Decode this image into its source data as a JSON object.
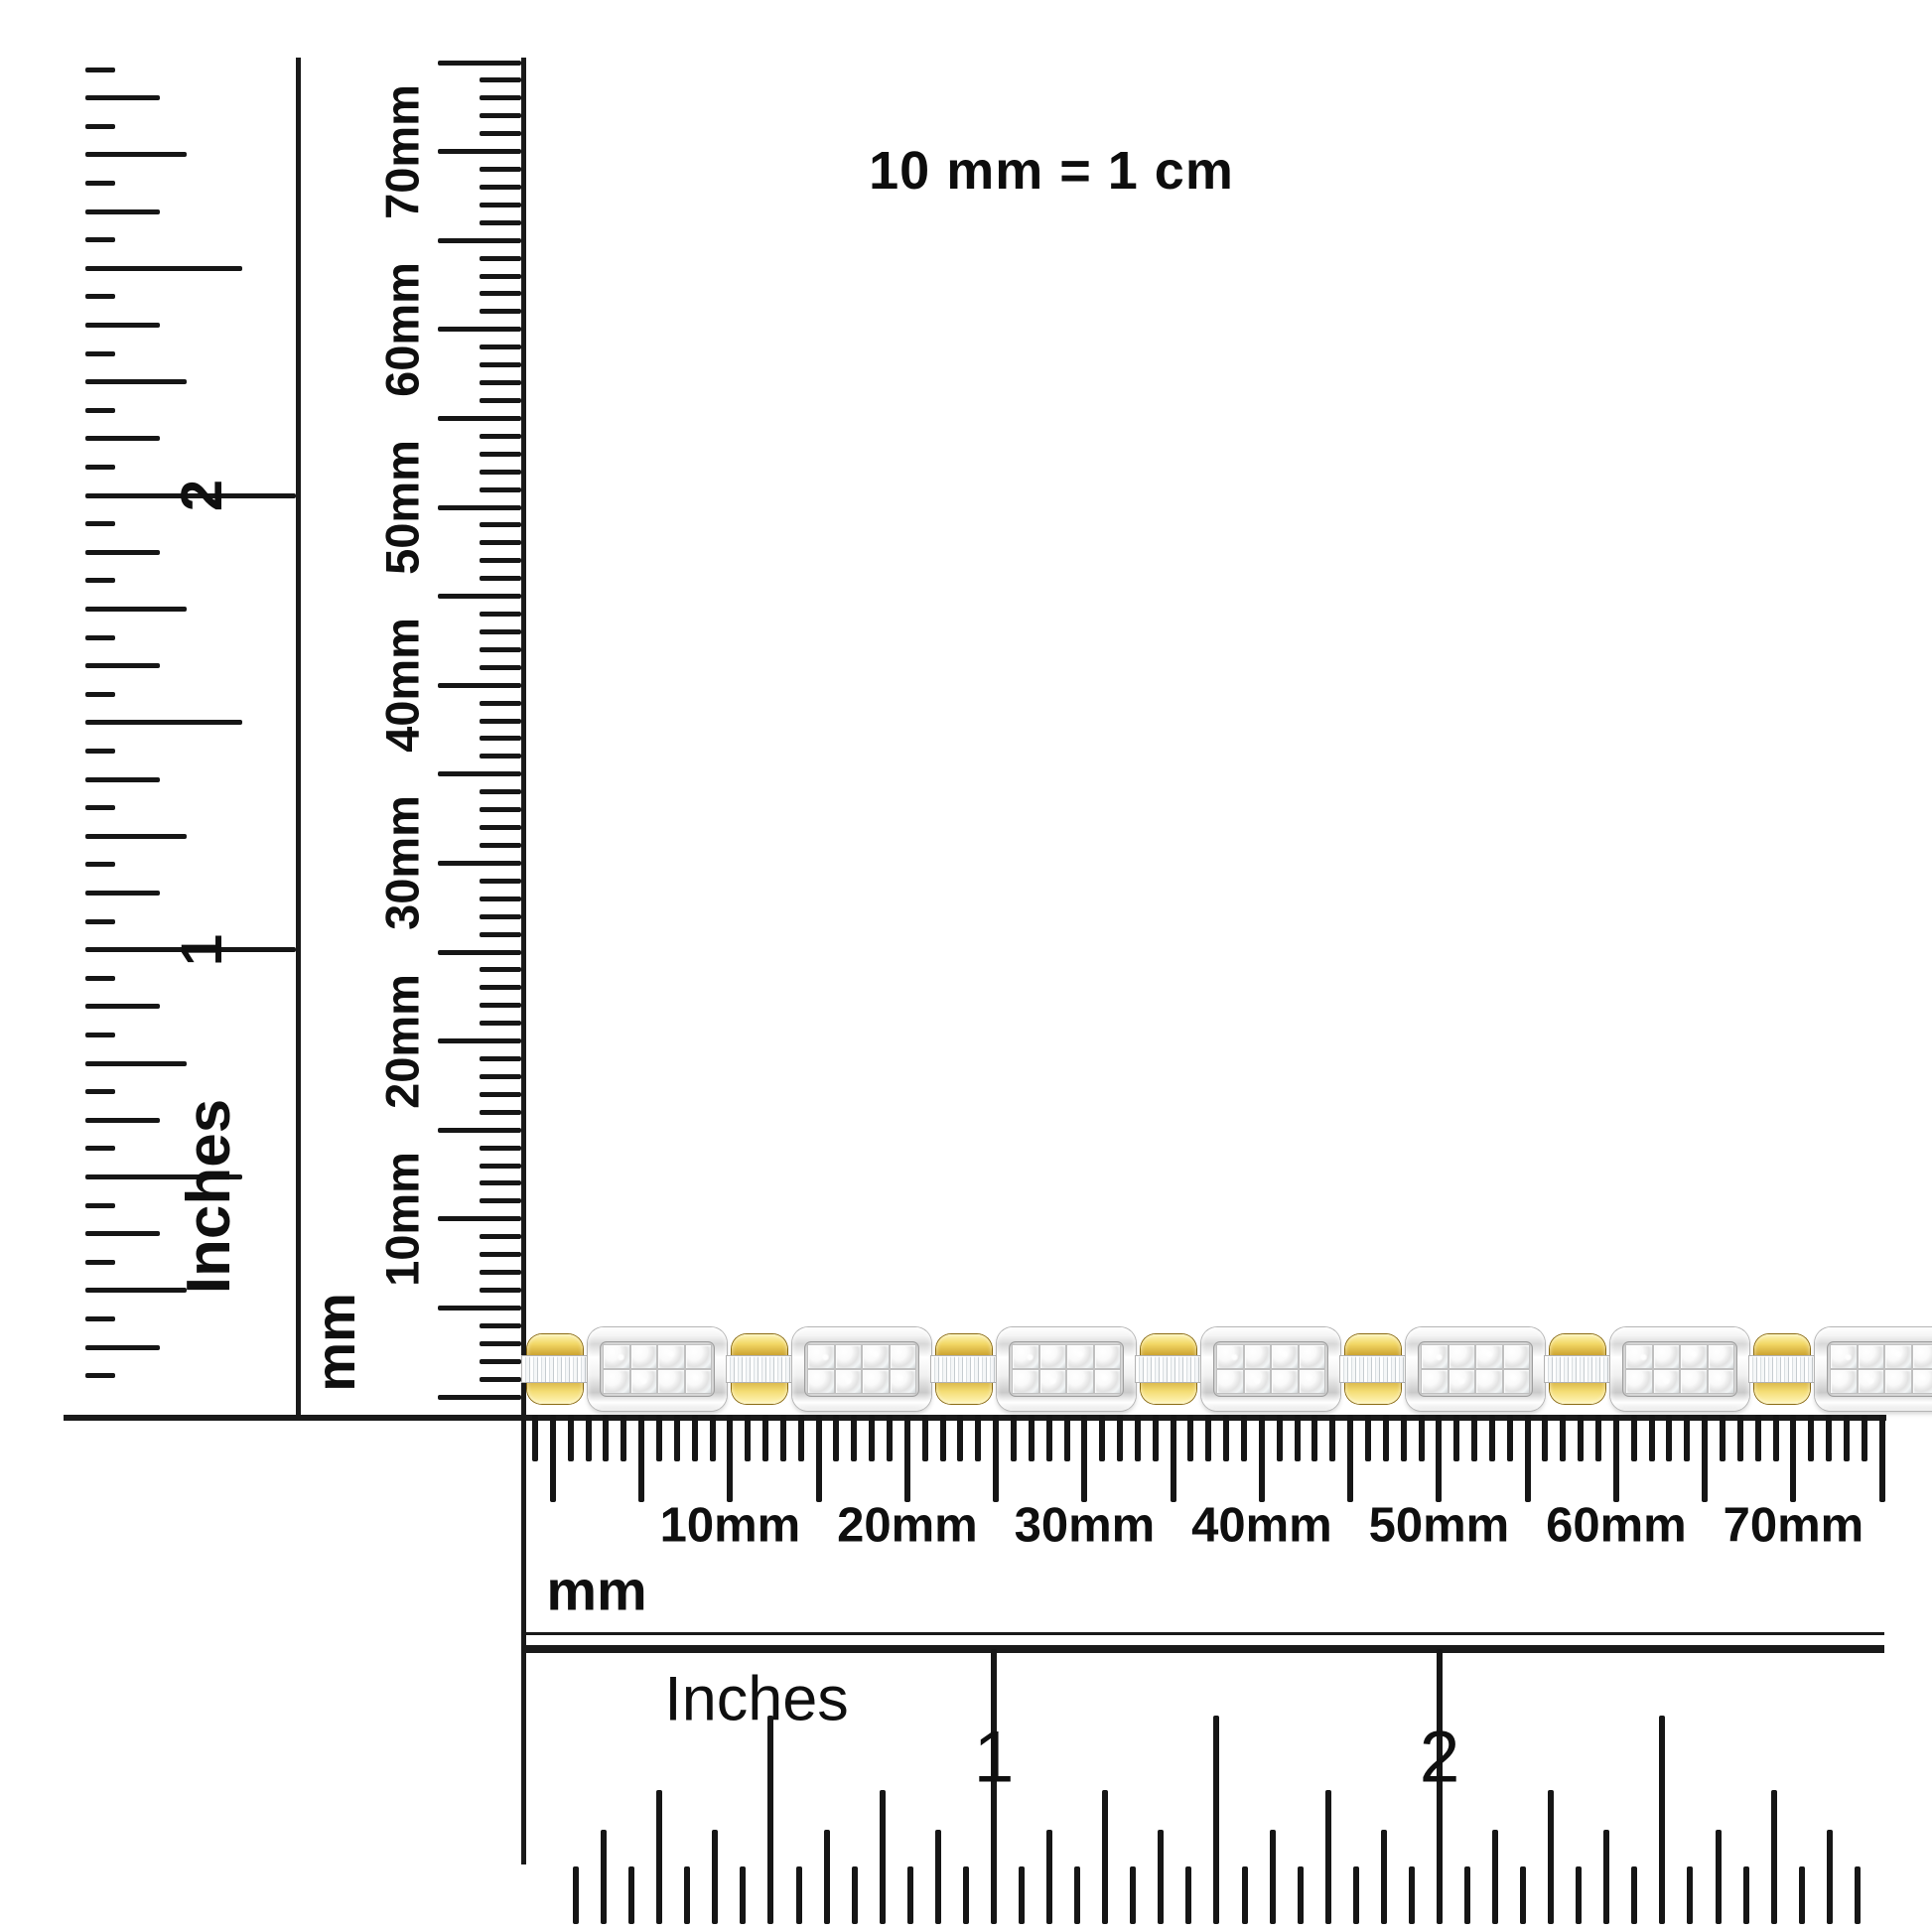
{
  "note": "10 mm = 1 cm",
  "left_inches_ruler": {
    "unit": "Inches",
    "digit_labels": [
      "2",
      "1"
    ]
  },
  "vertical_mm_ruler": {
    "unit": "mm",
    "tick_labels": [
      "70mm",
      "60mm",
      "50mm",
      "40mm",
      "30mm",
      "20mm",
      "10mm"
    ]
  },
  "horizontal_mm_ruler": {
    "unit": "mm",
    "tick_labels": [
      "10mm",
      "20mm",
      "30mm",
      "40mm",
      "50mm",
      "60mm",
      "70mm"
    ]
  },
  "bottom_inches_ruler": {
    "unit": "Inches",
    "digit_labels": [
      "1",
      "2"
    ]
  },
  "bracelet": {
    "description": "two-tone gold and white-gold diamond tennis bracelet with princess-cut diamond links and baguette diamond connectors",
    "link_count": 7,
    "stones_per_link": 8,
    "colors": {
      "gold": "#d9ad3c",
      "gold_light": "#f9e78f",
      "gold_dark": "#8f6d12",
      "silver_light": "#ffffff",
      "silver": "#e9e9e9",
      "silver_dark": "#b5b5b5",
      "diamond": "#f4f4f4"
    }
  }
}
